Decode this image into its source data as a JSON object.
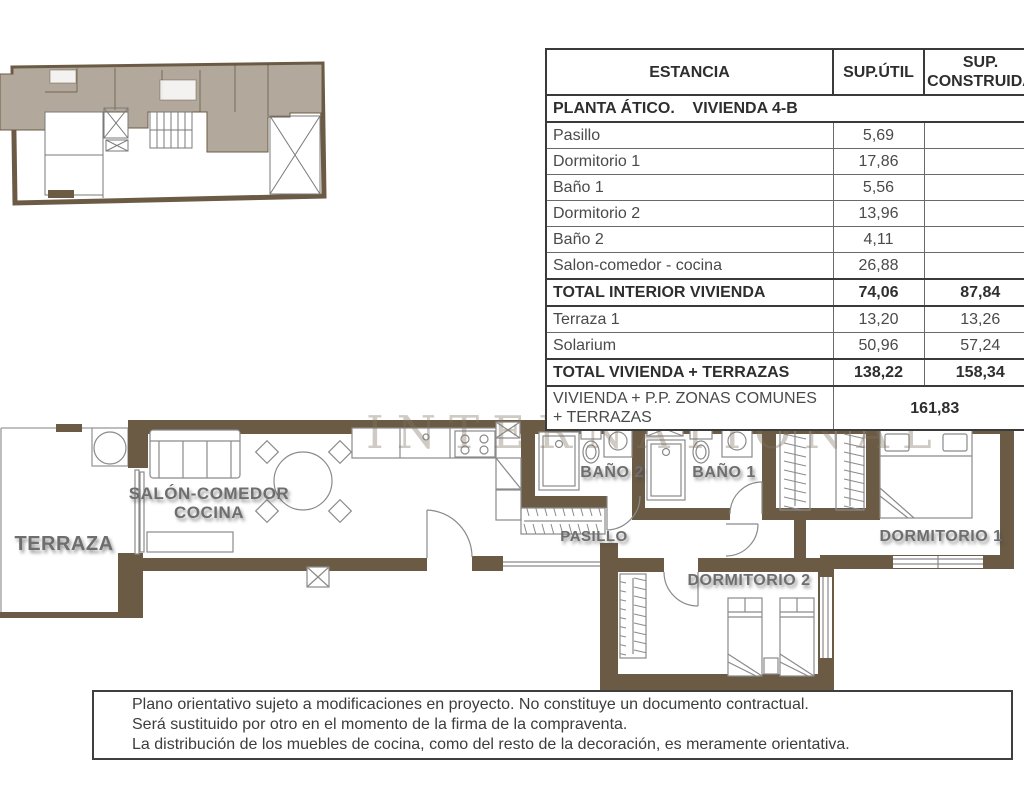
{
  "table": {
    "headers": [
      "ESTANCIA",
      "SUP.ÚTIL",
      "SUP. CONSTRUIDA"
    ],
    "section": "PLANTA ÁTICO.    VIVIENDA 4-B",
    "rows": [
      {
        "label": "Pasillo",
        "util": "5,69",
        "construida": ""
      },
      {
        "label": "Dormitorio 1",
        "util": "17,86",
        "construida": ""
      },
      {
        "label": "Baño 1",
        "util": "5,56",
        "construida": ""
      },
      {
        "label": "Dormitorio 2",
        "util": "13,96",
        "construida": ""
      },
      {
        "label": "Baño 2",
        "util": "4,11",
        "construida": ""
      },
      {
        "label": "Salon-comedor - cocina",
        "util": "26,88",
        "construida": ""
      },
      {
        "label": "TOTAL INTERIOR VIVIENDA",
        "util": "74,06",
        "construida": "87,84",
        "bold": true
      },
      {
        "label": "Terraza 1",
        "util": "13,20",
        "construida": "13,26"
      },
      {
        "label": "Solarium",
        "util": "50,96",
        "construida": "57,24"
      },
      {
        "label": "TOTAL VIVIENDA + TERRAZAS",
        "util": "138,22",
        "construida": "158,34",
        "bold": true
      },
      {
        "label": "VIVIENDA + P.P. ZONAS COMUNES + TERRAZAS",
        "util": "161,83",
        "span": true
      }
    ]
  },
  "plan": {
    "watermark": "INTERNATIONAL",
    "labels": {
      "terraza": "TERRAZA",
      "salon_line1": "SALÓN-COMEDOR",
      "salon_line2": "COCINA",
      "bano2": "BAÑO 2",
      "bano1": "BAÑO 1",
      "pasillo": "PASILLO",
      "dorm1": "DORMITORIO 1",
      "dorm2": "DORMITORIO 2"
    }
  },
  "disclaimer": {
    "lines": [
      "Plano orientativo sujeto a modificaciones en proyecto. No constituye un documento contractual.",
      "Será sustituido por otro en el momento de la firma de la compraventa.",
      "La distribución de los muebles de cocina, como del resto de la decoración, es meramente orientativa."
    ]
  },
  "colors": {
    "wall_brown": "#6B5B45",
    "unit_shade": "#B2A89B",
    "label_gray": "#6E6E6E",
    "furniture_gray": "#8A8A8A"
  }
}
